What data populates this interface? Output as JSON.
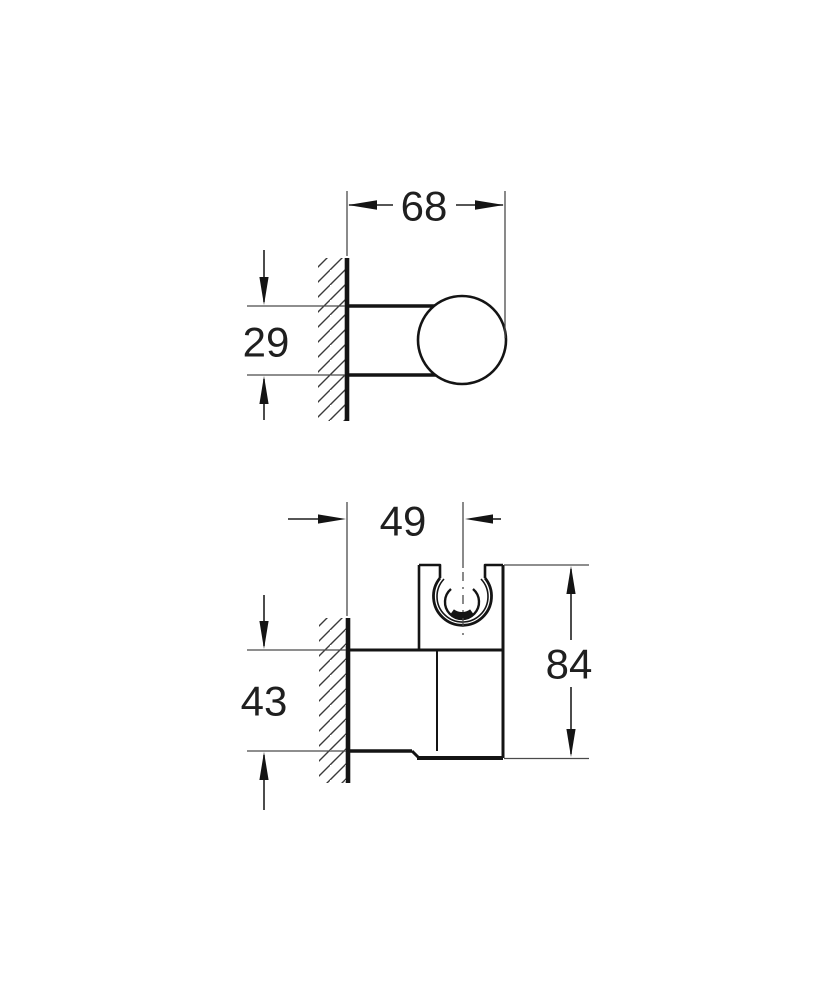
{
  "drawing": {
    "type": "technical-dimension-drawing",
    "subject": "wall-mounted hand shower holder, two orthographic views",
    "background_color": "#ffffff",
    "outline_color": "#141414",
    "thin_line_color": "#4a4a4a",
    "hatch_color": "#3a3a3a",
    "text_color": "#1f1f1f",
    "side_view": {
      "description": "side profile: round escutcheon on hatched wall with ball knob",
      "depth_label": "68",
      "height_label": "29"
    },
    "front_view": {
      "description": "side view of holder body with C-shaped shower clip, hatched wall",
      "offset_label": "49",
      "mount_height_label": "43",
      "total_height_label": "84"
    }
  }
}
